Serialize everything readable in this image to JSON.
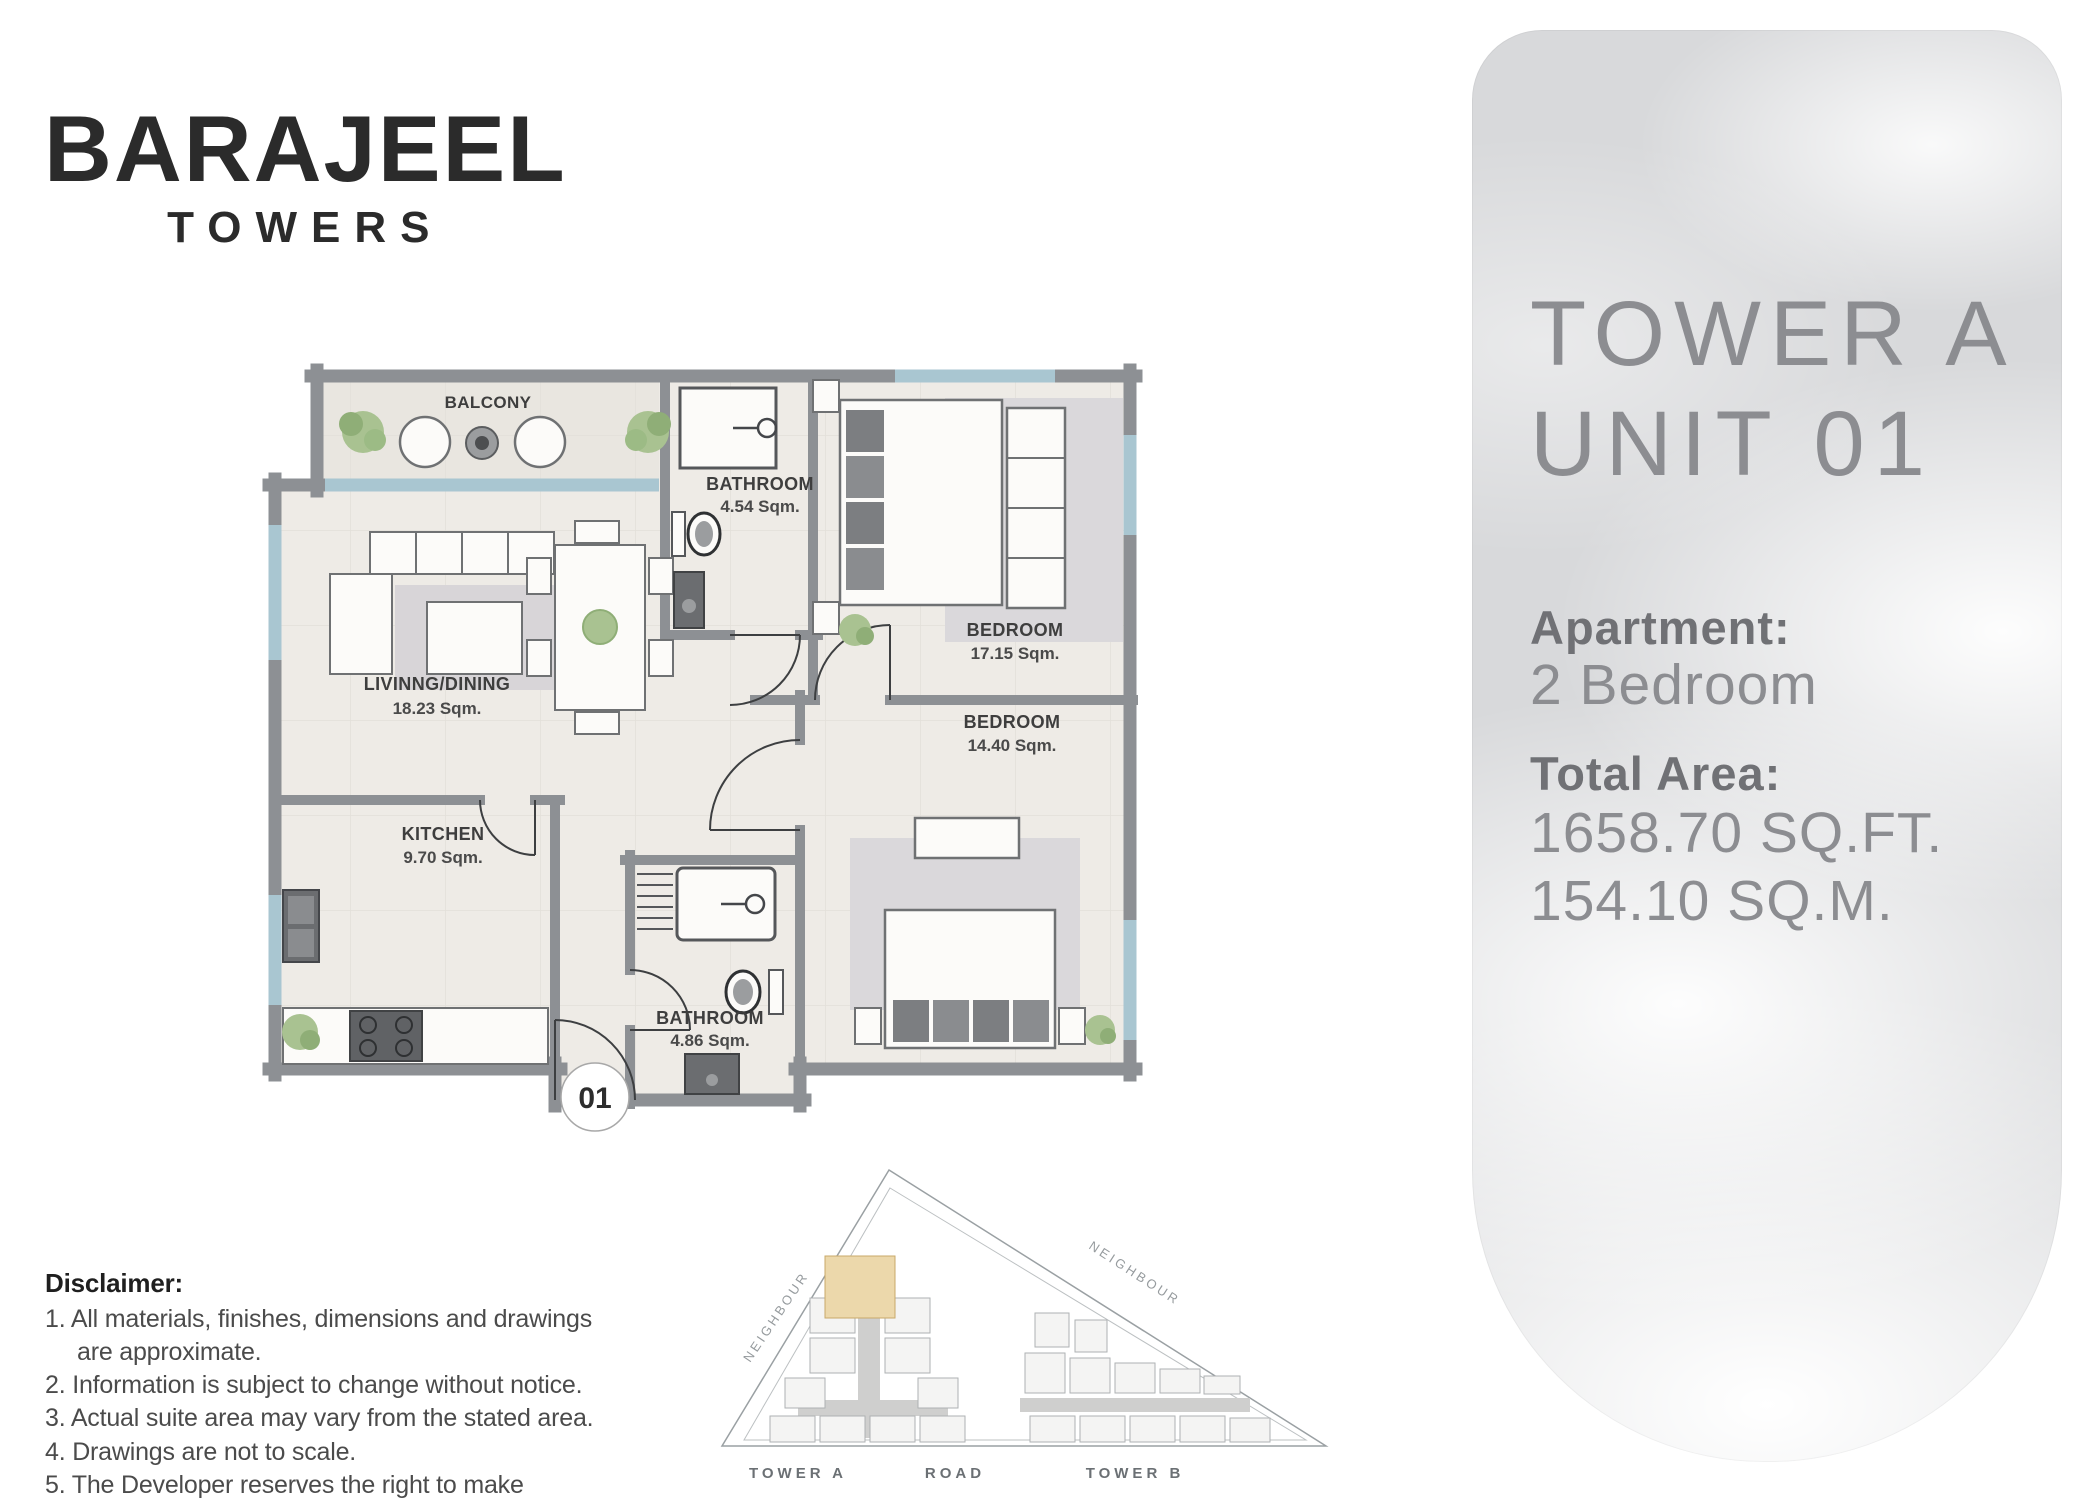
{
  "brand": {
    "name": "BARAJEEL",
    "subtitle": "TOWERS"
  },
  "floor_plan": {
    "balcony_label": "BALCONY",
    "unit_marker": "01",
    "rooms": {
      "bathroom_top": {
        "name": "BATHROOM",
        "area": "4.54 Sqm."
      },
      "bedroom_master": {
        "name": "BEDROOM",
        "area": "17.15 Sqm."
      },
      "living_dining": {
        "name": "LIVINNG/DINING",
        "area": "18.23 Sqm."
      },
      "bedroom_second": {
        "name": "BEDROOM",
        "area": "14.40 Sqm."
      },
      "kitchen": {
        "name": "KITCHEN",
        "area": "9.70 Sqm."
      },
      "bathroom_bottom": {
        "name": "BATHROOM",
        "area": "4.86 Sqm."
      }
    }
  },
  "site_plan": {
    "neighbour_left": "NEIGHBOUR",
    "neighbour_right": "NEIGHBOUR",
    "tower_a": "TOWER A",
    "road": "ROAD",
    "tower_b": "TOWER B"
  },
  "disclaimer": {
    "title": "Disclaimer:",
    "items": [
      "1. All materials, finishes, dimensions and drawings are approximate.",
      "2. Information is subject to change without notice.",
      "3. Actual suite area may vary from the stated area.",
      "4. Drawings are not to scale.",
      "5. The Developer reserves the right to make revisions /alterations without any liability whatsoever."
    ]
  },
  "info_panel": {
    "tower": "TOWER A",
    "unit": "UNIT 01",
    "apartment_label": "Apartment:",
    "apartment_value": "2 Bedroom",
    "total_area_label": "Total Area:",
    "area_sqft": "1658.70 SQ.FT.",
    "area_sqm": "154.10 SQ.M."
  },
  "colors": {
    "wall": "#8d9094",
    "window": "#a9c6d1",
    "floor": "#eeebe6",
    "balcony_floor": "#e9e6e0",
    "highlight_unit": "#ecd8ab",
    "panel_text": "#8c8d91",
    "panel_label": "#707175",
    "brand_text": "#2b2b2b"
  }
}
